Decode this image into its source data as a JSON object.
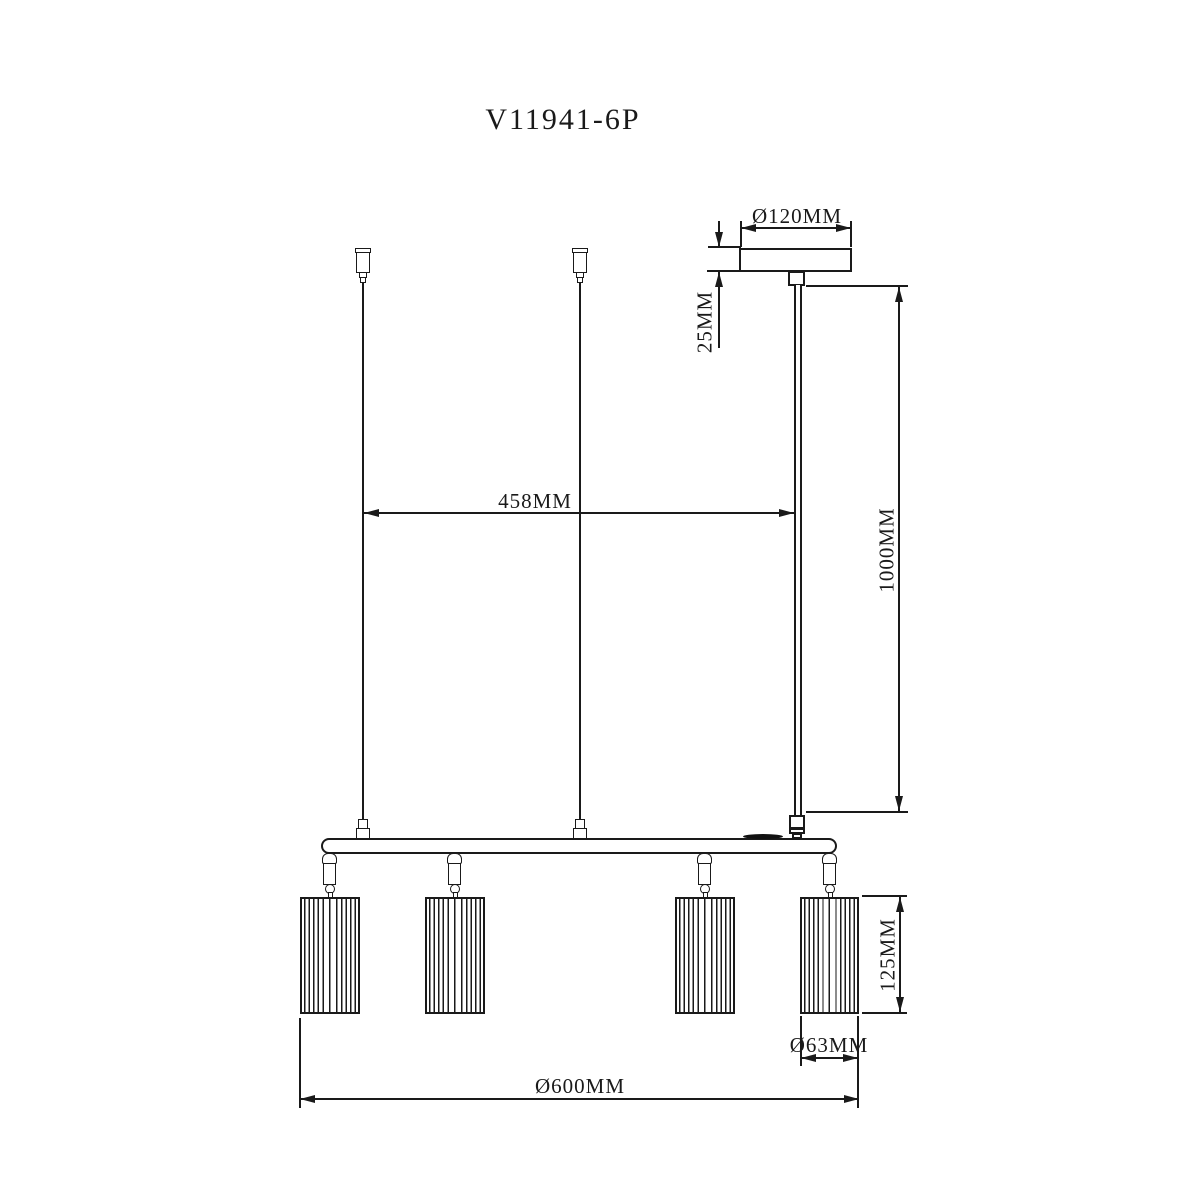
{
  "drawing": {
    "title": "V11941-6P",
    "dimensions": {
      "canopy_diameter": "Ø120MM",
      "canopy_height": "25MM",
      "suspension_spacing": "458MM",
      "drop_height": "1000MM",
      "shade_height": "125MM",
      "shade_diameter": "Ø63MM",
      "fixture_diameter": "Ø600MM"
    },
    "colors": {
      "line": "#1a1a1a",
      "background": "#ffffff"
    }
  }
}
